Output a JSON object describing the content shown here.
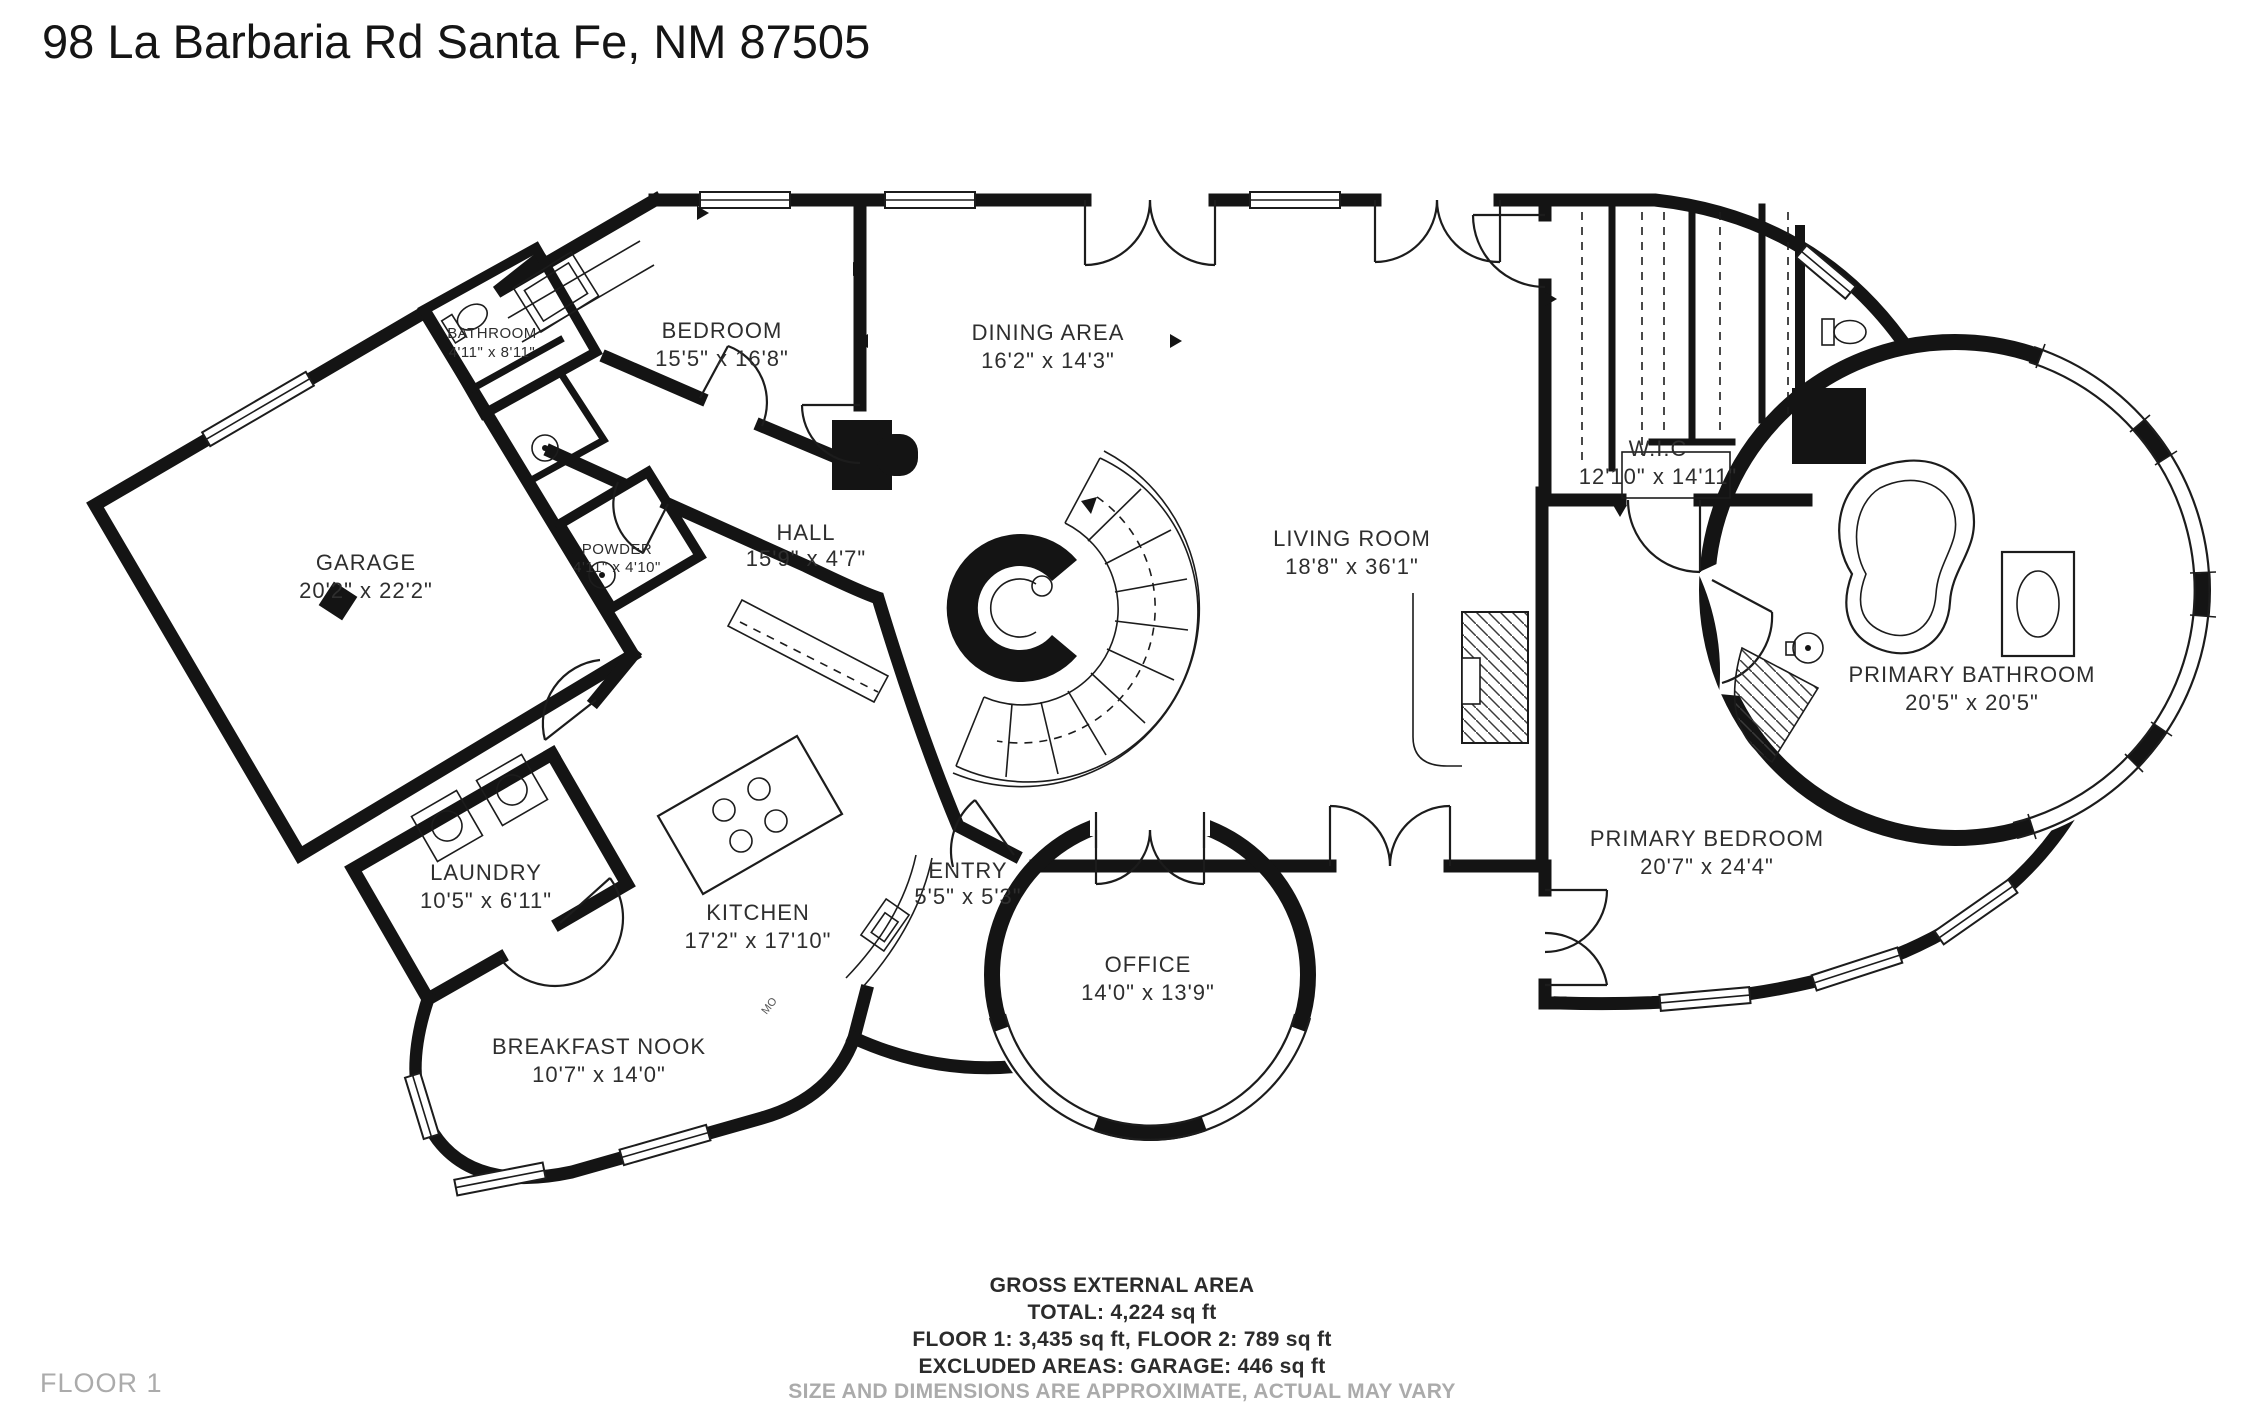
{
  "title": "98 La Barbaria Rd Santa Fe, NM 87505",
  "floor_label": "FLOOR 1",
  "rooms": [
    {
      "name": "BATHROOM",
      "dims": "4'11\" x 8'11\""
    },
    {
      "name": "BEDROOM",
      "dims": "15'5\" x 16'8\""
    },
    {
      "name": "DINING AREA",
      "dims": "16'2\" x 14'3\""
    },
    {
      "name": "GARAGE",
      "dims": "20'2\" x 22'2\""
    },
    {
      "name": "POWDER",
      "dims": "4'11\" x 4'10\""
    },
    {
      "name": "HALL",
      "dims": "15'9\" x 4'7\""
    },
    {
      "name": "LIVING ROOM",
      "dims": "18'8\" x 36'1\""
    },
    {
      "name": "W.I.C",
      "dims": "12'10\" x 14'11\""
    },
    {
      "name": "PRIMARY BATHROOM",
      "dims": "20'5\" x 20'5\""
    },
    {
      "name": "LAUNDRY",
      "dims": "10'5\" x 6'11\""
    },
    {
      "name": "KITCHEN",
      "dims": "17'2\" x 17'10\""
    },
    {
      "name": "ENTRY",
      "dims": "5'5\" x 5'3\""
    },
    {
      "name": "OFFICE",
      "dims": "14'0\" x 13'9\""
    },
    {
      "name": "PRIMARY BEDROOM",
      "dims": "20'7\" x 24'4\""
    },
    {
      "name": "BREAKFAST NOOK",
      "dims": "10'7\" x 14'0\""
    }
  ],
  "footer": {
    "heading": "GROSS EXTERNAL AREA",
    "total": "TOTAL: 4,224 sq ft",
    "floors": "FLOOR 1: 3,435 sq ft, FLOOR 2: 789 sq ft",
    "excluded": "EXCLUDED AREAS: GARAGE: 446 sq ft",
    "disclaimer": "SIZE AND DIMENSIONS ARE APPROXIMATE, ACTUAL MAY VARY"
  },
  "plan": {
    "counter_note": "MO"
  },
  "colors": {
    "wall": "#141414",
    "text": "#2e2e2e",
    "muted": "#ababab"
  }
}
